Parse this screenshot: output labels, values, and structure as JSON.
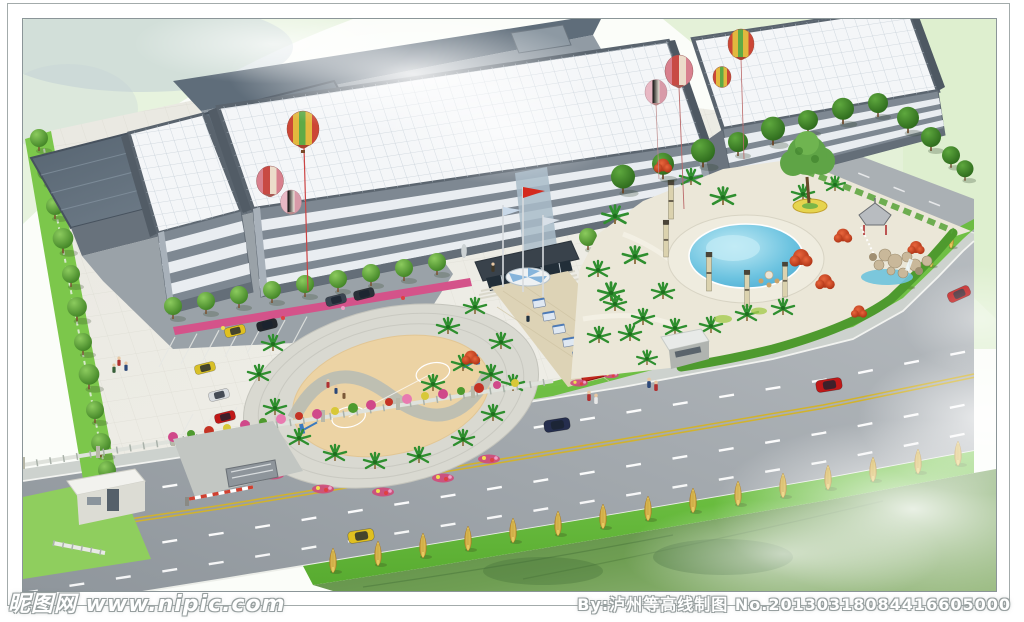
{
  "watermarks": {
    "site": "昵图网 www.nipic.com",
    "credit": "By:泸州等高线制图 No.20130318084416605000"
  },
  "scene": {
    "alt": "Aerial 3D architectural rendering of a factory campus: gray multi-storey buildings with white grid roofs and hot-air balloons, entrance plaza with flagpoles and display boards, circular basketball court, parking lot with gate house, landscaped garden with round swimming pool, pavilion and rockery, and a tree-lined road with cars in front",
    "palette": {
      "backdrop_green": "#e6f2dc",
      "roof_white": "#f4f6f8",
      "roof_slate": "#5d6b78",
      "facade_gray": "#7e8892",
      "window_band": "#e9edf1",
      "road_asphalt": "#979da2",
      "lane_yellow": "#d2b32c",
      "verge_green": "#68bd3c",
      "tree_green": "#4f9a30",
      "tree_yellow": "#e3bf49",
      "court_tan": "#ecd3a4",
      "pool_blue": "#4fb4d8",
      "maple_red": "#cf3d1f",
      "flower_magenta": "#d0498a",
      "flag_red": "#d42a1e"
    }
  }
}
